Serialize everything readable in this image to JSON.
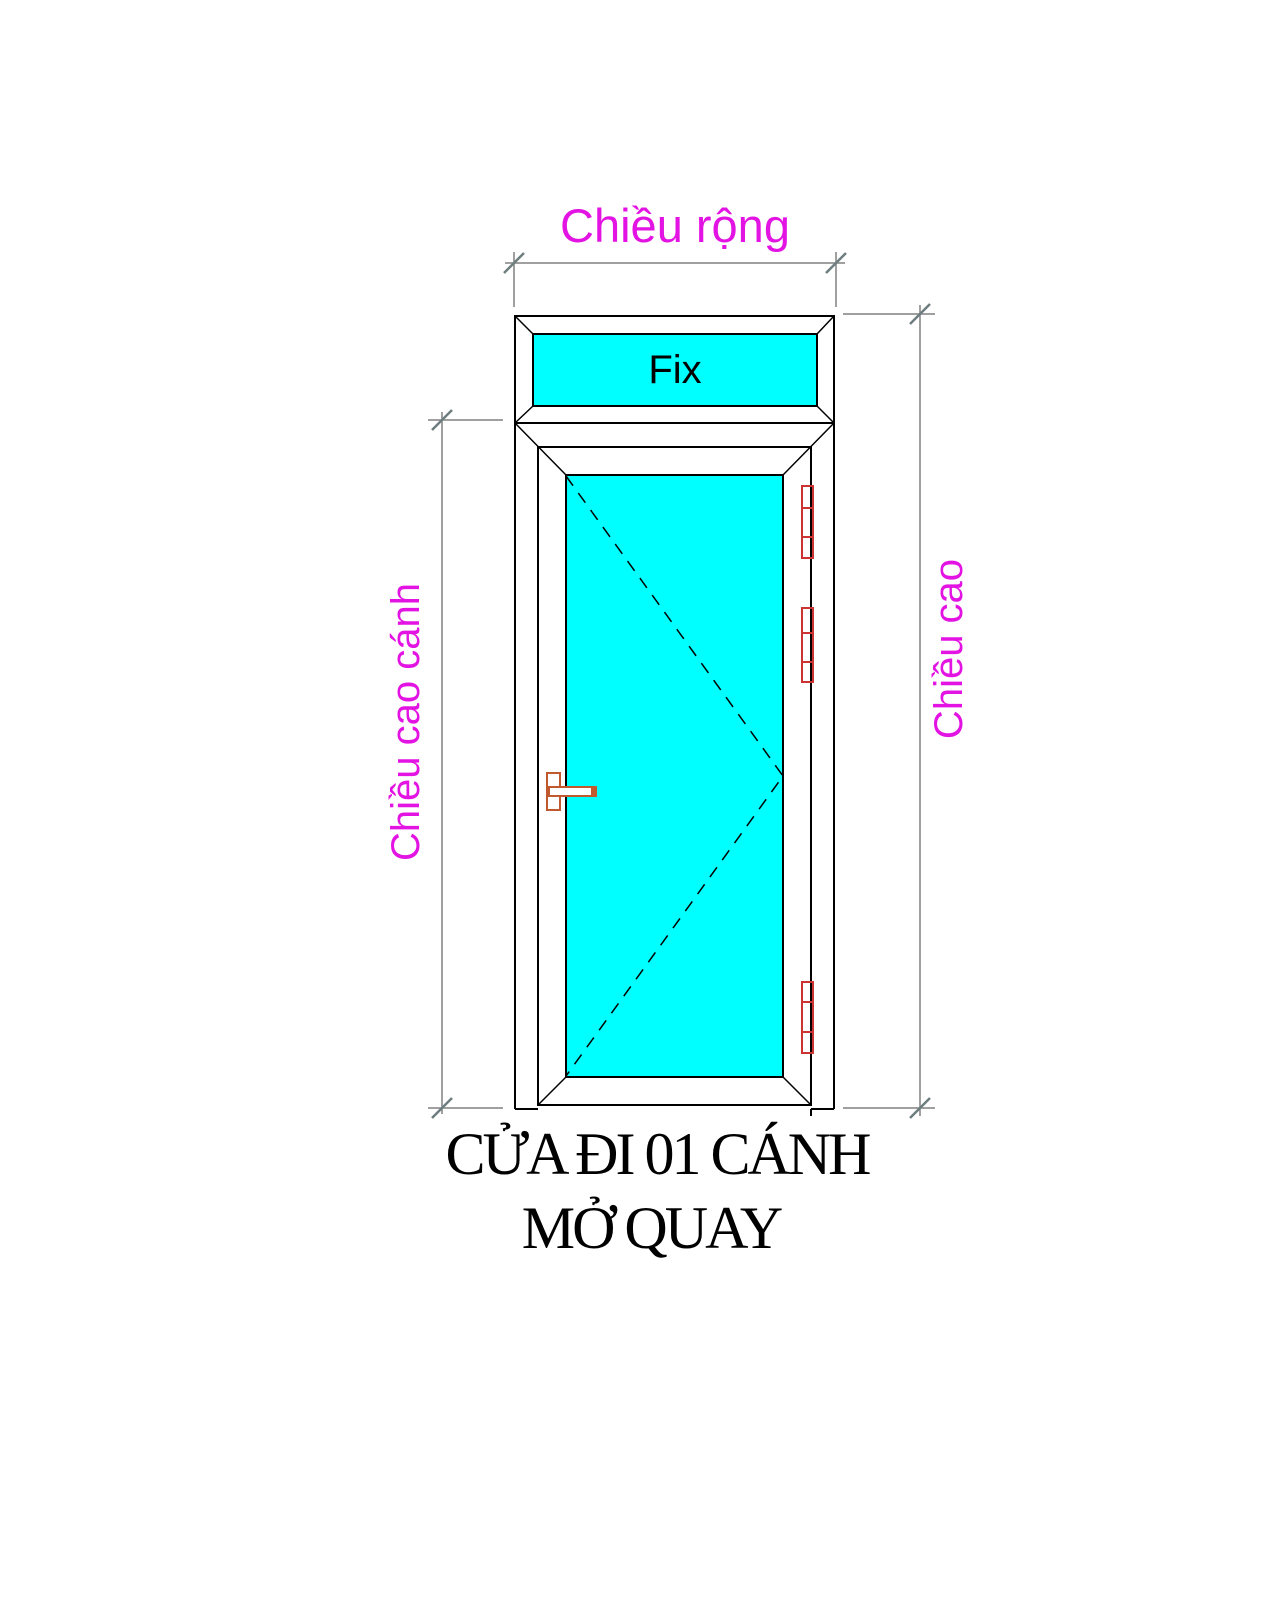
{
  "diagram": {
    "labels": {
      "width": "Chiều rộng",
      "leaf_height": "Chiều cao cánh",
      "height": "Chiều cao",
      "fix": "Fix"
    },
    "title": {
      "line1": "CỬA ĐI 01 CÁNH",
      "line2": "MỞ QUAY"
    },
    "colors": {
      "glass": "#00ffff",
      "outline": "#000000",
      "dimension_label": "#e314e3",
      "dimension_line": "#818181",
      "tick": "#6e7e7e",
      "hinge": "#cc3333",
      "handle": "#c05a2e",
      "background": "#ffffff",
      "title_color": "#000000"
    }
  }
}
